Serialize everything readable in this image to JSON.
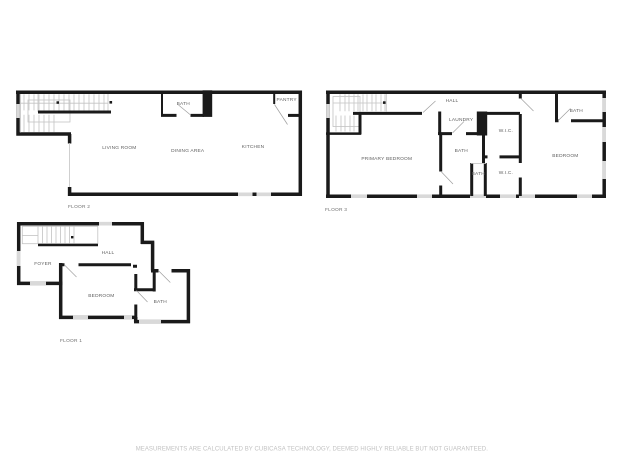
{
  "colors": {
    "wall": "#1a1a1a",
    "window": "#d9d9d9",
    "stair": "#c3c3c3",
    "door": "#9e9e9e",
    "label": "#5e5e5e",
    "caption": "#6f6f6f",
    "disclaimer": "#c2c2c2",
    "background": "#ffffff"
  },
  "disclaimer": "MEASUREMENTS ARE CALCULATED BY CUBICASA TECHNOLOGY, DEEMED HIGHLY RELIABLE BUT NOT GUARANTEED.",
  "floors": {
    "floor2": {
      "caption": "FLOOR 2",
      "rooms": {
        "living_room": "LIVING ROOM",
        "dining_area": "DINING AREA",
        "kitchen": "KITCHEN",
        "bath": "BATH",
        "pantry": "PANTRY"
      }
    },
    "floor3": {
      "caption": "FLOOR 3",
      "rooms": {
        "hall": "HALL",
        "laundry": "LAUNDRY",
        "primary_bedroom": "PRIMARY BEDROOM",
        "bath": "BATH",
        "bath_small": "BATH",
        "bath_top": "BATH",
        "wic_upper": "W.I.C.",
        "wic_lower": "W.I.C.",
        "bedroom": "BEDROOM"
      }
    },
    "floor1": {
      "caption": "FLOOR 1",
      "rooms": {
        "foyer": "FOYER",
        "hall": "HALL",
        "bedroom": "BEDROOM",
        "bath": "BATH"
      }
    }
  }
}
